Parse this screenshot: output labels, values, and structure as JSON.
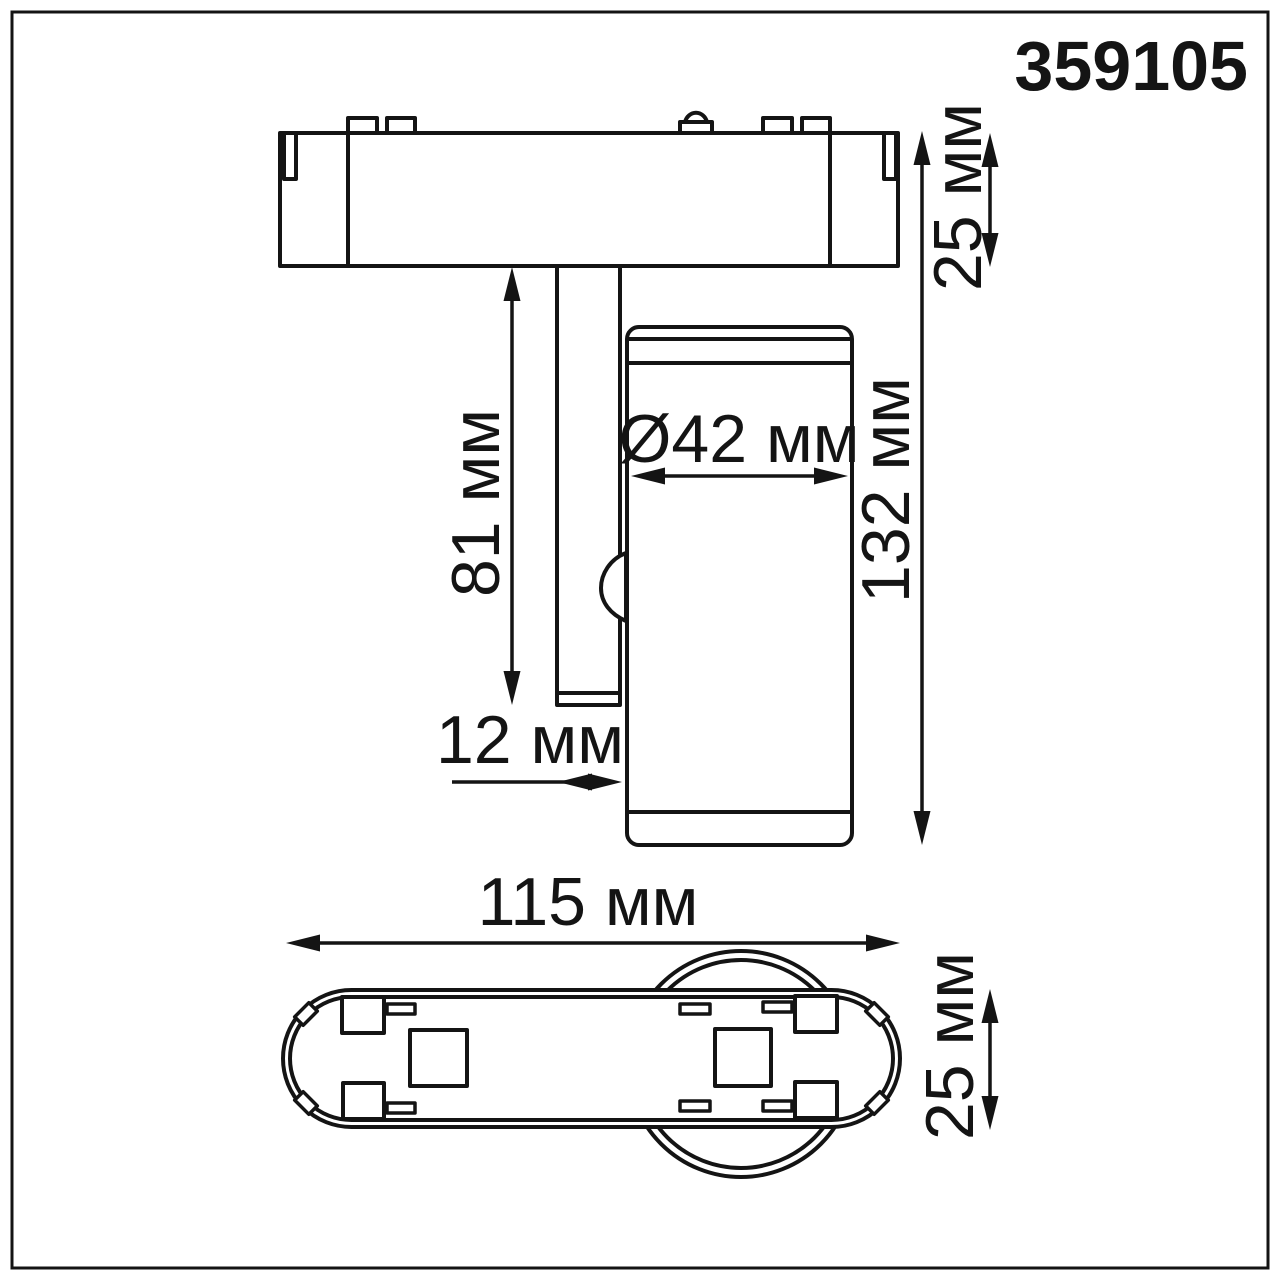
{
  "product_code": "359105",
  "drawing": {
    "type": "technical-dimension-drawing",
    "views": [
      "side view",
      "bottom view"
    ],
    "line_color": "#141414",
    "background": "#ffffff"
  },
  "dimensions": {
    "base_height": "25 мм",
    "stem_length": "81 мм",
    "head_diameter": "Ø42 мм",
    "total_height": "132 мм",
    "stem_width": "12 мм",
    "base_length": "115 мм",
    "base_width": "25 мм"
  }
}
